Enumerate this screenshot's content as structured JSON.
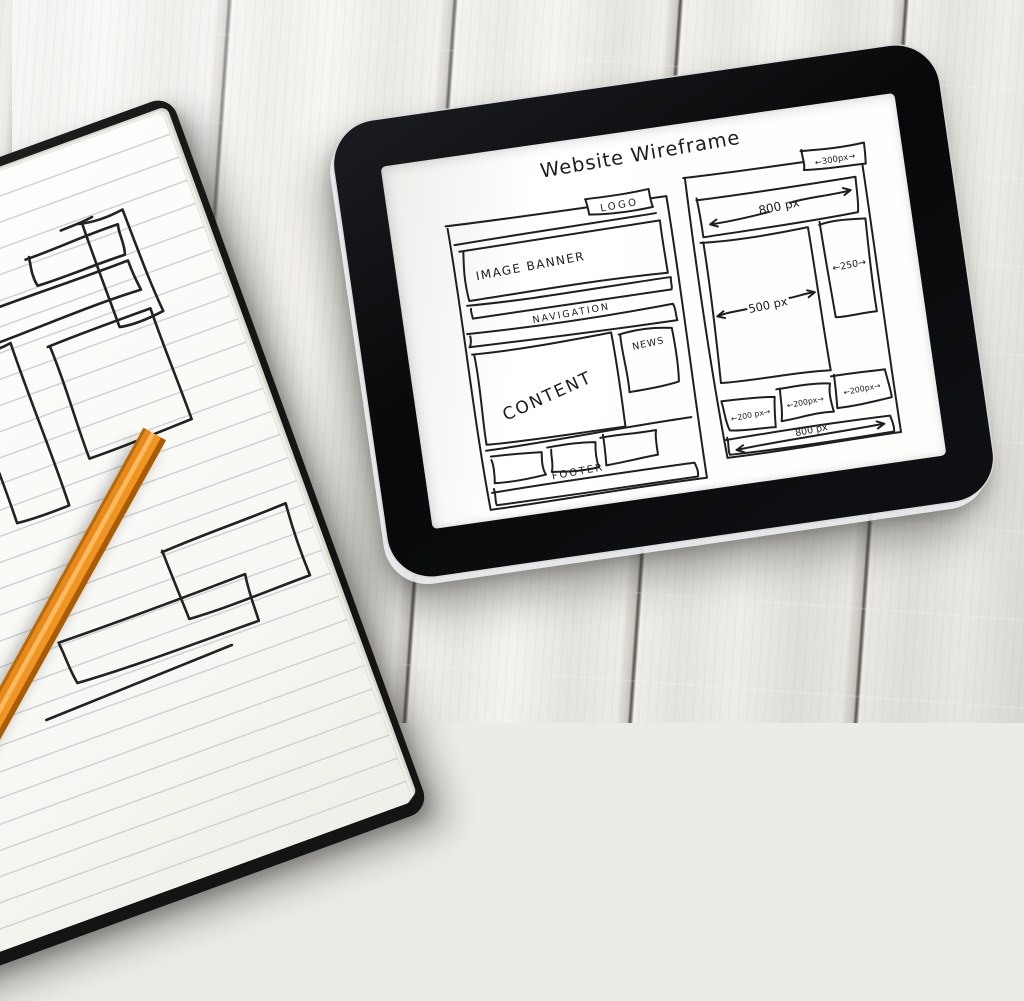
{
  "wireframe_screen": {
    "title": "Website Wireframe",
    "left_page": {
      "logo": "LOGO",
      "image_banner": "IMAGE BANNER",
      "navigation": "NAVIGATION",
      "content": "CONTENT",
      "news": "NEWS",
      "footer": "FOOTER"
    },
    "right_page": {
      "top_box_width": "←300px→",
      "banner_width": "800 px",
      "main_width": "500 px",
      "sidebar_width": "←250→",
      "small_box1_width": "←200 px→",
      "small_box2_width": "←200px→",
      "small_box3_width": "←200px→",
      "bottom_width": "800 px"
    }
  },
  "colors": {
    "ink": "#1f1f1f",
    "pencil_orange": "#ee8c14",
    "tablet_body": "#0a0a0c",
    "screen_white": "#fcfcfb",
    "wood": "#ecebe7",
    "notebook_cover": "#191919",
    "paper": "#fbfbf8"
  }
}
